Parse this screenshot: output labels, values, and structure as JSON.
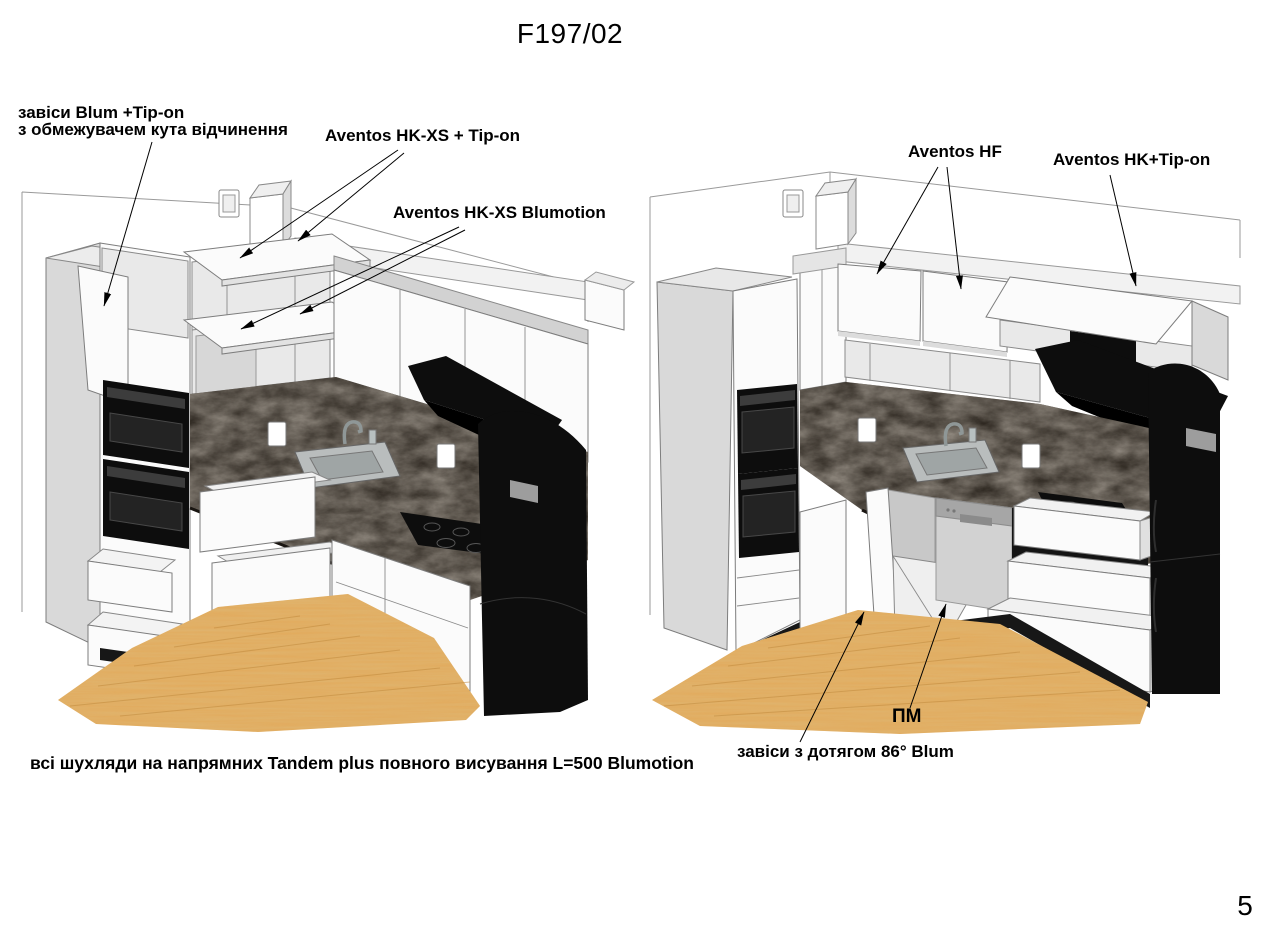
{
  "header": {
    "title": "F197/02"
  },
  "page": {
    "number": "5"
  },
  "left_view": {
    "annotations": {
      "hinges_tipon_line1": "завіси Blum +Tip-on",
      "hinges_tipon_line2": "з обмежувачем кута відчинення",
      "aventos_hkxs_tipon": "Aventos HK-XS + Tip-on",
      "aventos_hkxs_blumotion": "Aventos HK-XS Blumotion"
    }
  },
  "right_view": {
    "annotations": {
      "aventos_hf": "Aventos HF",
      "aventos_hk_tipon": "Aventos HK+Tip-on",
      "pm": "ПМ",
      "hinges_86": "завіси з дотягом 86° Blum"
    }
  },
  "footer": {
    "drawers_note": "всі шухляди на напрямних Tandem plus повного висування L=500 Blumotion"
  },
  "colors": {
    "page_bg": "#ffffff",
    "text": "#000000",
    "cabinet_white": "#fbfbfb",
    "cabinet_side": "#d9d9d9",
    "countertop": "#262019",
    "appliance_black": "#0d0d0d",
    "steel": "#cccccc",
    "floor_wood": "#e2aa5c"
  }
}
